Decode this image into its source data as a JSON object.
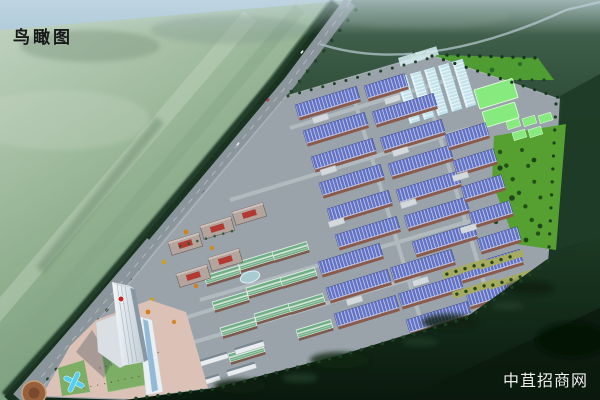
{
  "overlay": {
    "title": "鸟瞰图",
    "watermark": "中苴招商网"
  },
  "colors": {
    "title": "#17191a",
    "watermark": "#ffffff",
    "sky-top": "#b2cddd",
    "farm-green": "#9db99b",
    "road": "#8b959c",
    "platform": "#9aa3aa",
    "street": "#b4bdc2",
    "roof-blue": "#6272c4",
    "roof-cyan": "#c3e2ec",
    "roof-teal": "#6fae84",
    "wall-brown": "#8a5a4c",
    "wall-teal": "#7d5a4e",
    "block-green": "#86ea7e",
    "field-green": "#55a030",
    "tree-green": "#1e4723",
    "forest": "#12301c",
    "accent-red": "#b23a32",
    "logo-red": "#c5231f",
    "plaza": "#dcc2b6",
    "lawn": "#7cae65",
    "water": "#58cdef",
    "tower": "#f2f6f8"
  }
}
